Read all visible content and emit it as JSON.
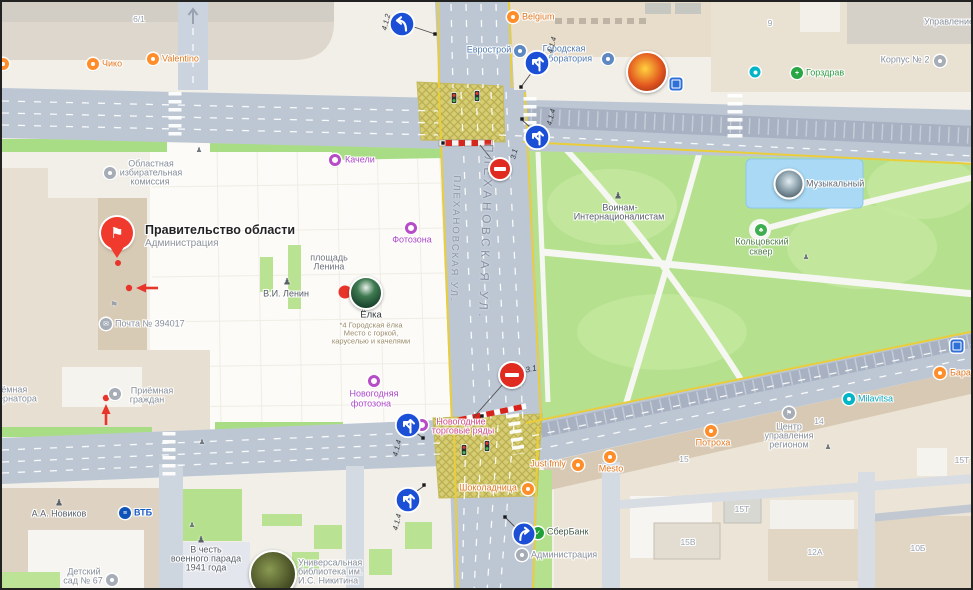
{
  "streets": {
    "left": "ПЛЕХАНОВСКАЯ УЛ.",
    "right": "ПЛЕХАНОВСКАЯ УЛ."
  },
  "signs": {
    "s1": "4.1.2",
    "s2": "4.1.4",
    "s3": "4.1.4",
    "s4": "3.1",
    "s5": "3.1",
    "s6": "4.1.4",
    "s7": "4.1.4"
  },
  "landmark": {
    "title": "Правительство области",
    "subtitle": "Администрация"
  },
  "pois": {
    "chiko": "Чико",
    "valentino": "Valentino",
    "belgium": "Belgium",
    "evrostroy": "Еврострой",
    "gorlab_1": "Городская",
    "gorlab_2": "лаборатория",
    "gorzdrav": "Горздрав",
    "korpus2": "Корпус № 2",
    "upravlenie": "Управление",
    "oblast_1": "Областная",
    "oblast_2": "избирательная",
    "oblast_3": "комиссия",
    "kacheli": "Качели",
    "fotozona": "Фотозона",
    "ploshchad_1": "площадь",
    "ploshchad_2": "Ленина",
    "lenin": "В.И. Ленин",
    "elka": "Ёлка",
    "elka_sub1": "*4 Городская ёлка",
    "elka_sub2": "Место с горкой,",
    "elka_sub3": "каруселью и качелями",
    "pochta": "Почта № 394017",
    "priemnaya_gub_1": "Приёмная",
    "priemnaya_gub_2": "губернатора",
    "priemnaya_gr_1": "Приёмная",
    "priemnaya_gr_2": "граждан",
    "ng_fotozona_1": "Новогодняя",
    "ng_fotozona_2": "фотозона",
    "ng_torg_1": "Новогодние",
    "ng_torg_2": "торговые ряды",
    "shokoladnitsa": "Шоколадница",
    "voinam_1": "Воинам-",
    "voinam_2": "Интернационалистам",
    "koltsovsky_1": "Кольцовский",
    "koltsovsky_2": "сквер",
    "muzykalny": "Музыкальный",
    "milavitsa": "Milavitsa",
    "bara": "Бара",
    "centr_1": "Центр",
    "centr_2": "управления",
    "centr_3": "регионом",
    "potroha": "Потроха",
    "just_fmly": "Just fmly",
    "mesto": "Mesto",
    "sberbank": "СберБанк",
    "administratsiya": "Администрация",
    "novikov": "А.А. Новиков",
    "vtb": "ВТБ",
    "parad_1": "В честь",
    "parad_2": "военного парада",
    "parad_3": "1941 года",
    "detsad_1": "Детский",
    "detsad_2": "сад № 67",
    "biblioteka_1": "Универсальная",
    "biblioteka_2": "библиотека им.",
    "biblioteka_3": "И.С. Никитина"
  },
  "houses": {
    "h6_1": "6/1",
    "h9": "9",
    "h14": "14",
    "h15": "15",
    "h15t": "15Т",
    "h15t2": "15Т",
    "h15v": "15В",
    "h12a": "12А",
    "h10b": "10Б"
  },
  "colors": {
    "accent_red": "#f03a2d",
    "sign_blue": "#1a4fd6",
    "no_entry_red": "#e02b20",
    "park_green": "#b5e18e",
    "road_grey": "#bdc7d4",
    "box_yellow": "#d6cc71"
  }
}
